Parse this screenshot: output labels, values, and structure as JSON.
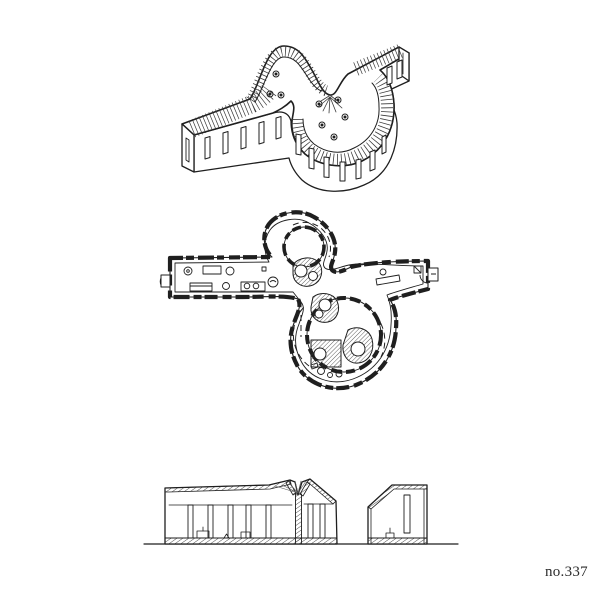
{
  "page": {
    "background_color": "#ffffff",
    "ink_color": "#1f1f1f",
    "hatch_color": "#3a3a3a"
  },
  "figure": {
    "label": "no.337"
  },
  "drawings": {
    "axonometric": {
      "name": "axonometric view of s-curved building with roof hatching, skylights and slot windows"
    },
    "plan": {
      "name": "floor plan of s-curved building with two loops, straight wings, poche cores and furniture"
    },
    "section": {
      "name": "cross section: long block with central roof funnel and smaller block on ground line"
    }
  }
}
